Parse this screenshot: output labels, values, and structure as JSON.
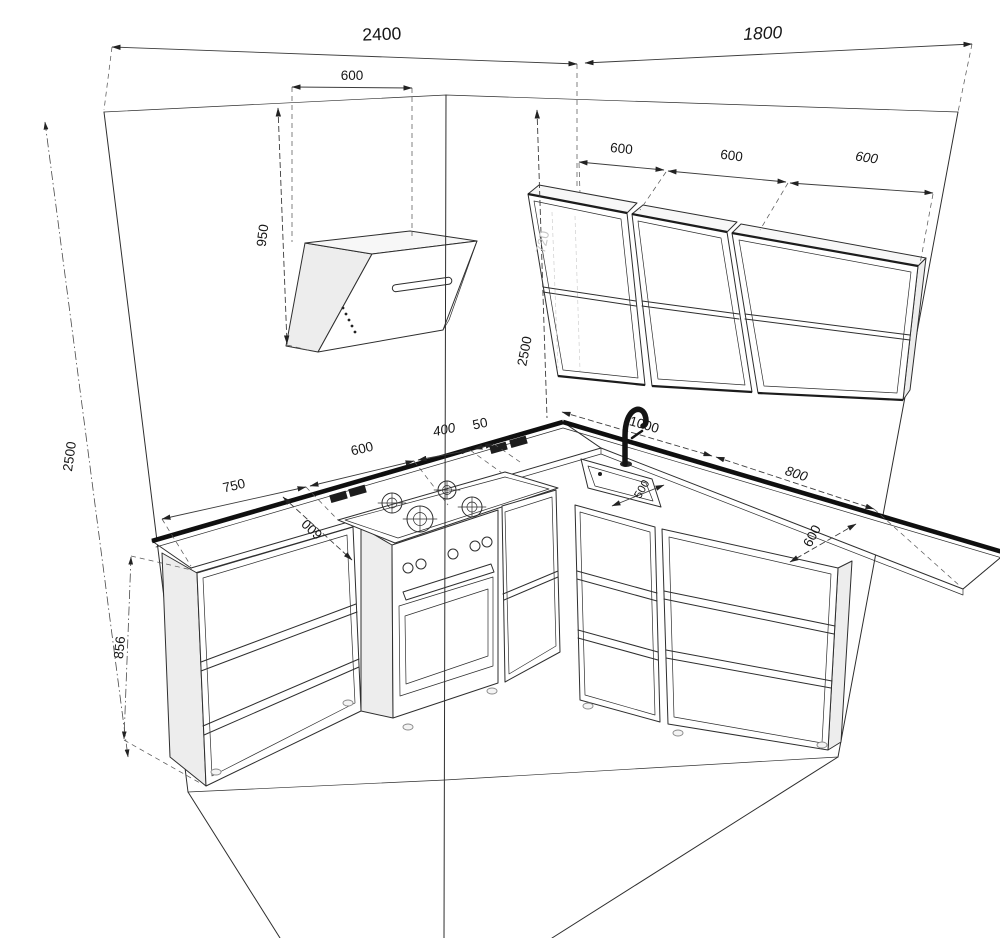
{
  "drawing": {
    "title": "L-shaped kitchen perspective line drawing with dimensions",
    "units": "mm",
    "line_color": "#2e2e2e",
    "counter_edge_color": "#0f0f0f",
    "faint_label_color": "#c6c6c6",
    "background": "#ffffff"
  },
  "dimensions": {
    "left_wall_width": "2400",
    "right_wall_width": "1800",
    "hood_width": "600",
    "ceiling_to_hood_bottom": "950",
    "room_height_left": "2500",
    "room_height_corner": "2500",
    "wall_cabinet_height_faint": "720",
    "wall_cabinet_1_width": "600",
    "wall_cabinet_2_width": "600",
    "wall_cabinet_3_width": "600",
    "left_base_cabinet_width": "750",
    "hob_width": "600",
    "right_of_hob_cabinet_width": "400",
    "corner_filler_width": "50",
    "left_counter_depth": "600",
    "sink_run_width": "1000",
    "sink_width": "500",
    "right_base_cabinet_width": "800",
    "right_counter_depth": "600",
    "base_cabinet_height": "856"
  }
}
